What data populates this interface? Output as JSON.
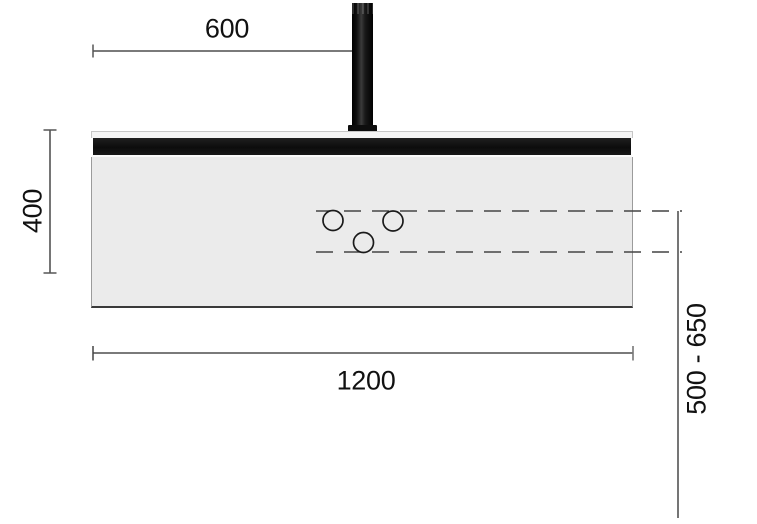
{
  "diagram": {
    "type": "technical-dimension-drawing",
    "labels": {
      "top_offset": "600",
      "panel_height": "400",
      "panel_width": "1200",
      "suspension_range": "500 - 650"
    },
    "colors": {
      "background": "#ffffff",
      "panel_body": "#ebebeb",
      "panel_top_strip": "#f4f4f4",
      "panel_black_strip": "#111111",
      "rod": "#141414",
      "dimension_line": "#2b2b2b",
      "dashed_line": "#444444",
      "tick": "#555555",
      "hole_stroke": "#1a1a1a",
      "text": "#111111"
    },
    "shapes": {
      "holes": [
        {
          "cx": 333,
          "cy": 220.5,
          "r": 10
        },
        {
          "cx": 393,
          "cy": 221,
          "r": 10
        },
        {
          "cx": 363.5,
          "cy": 242.5,
          "r": 10
        }
      ]
    }
  }
}
